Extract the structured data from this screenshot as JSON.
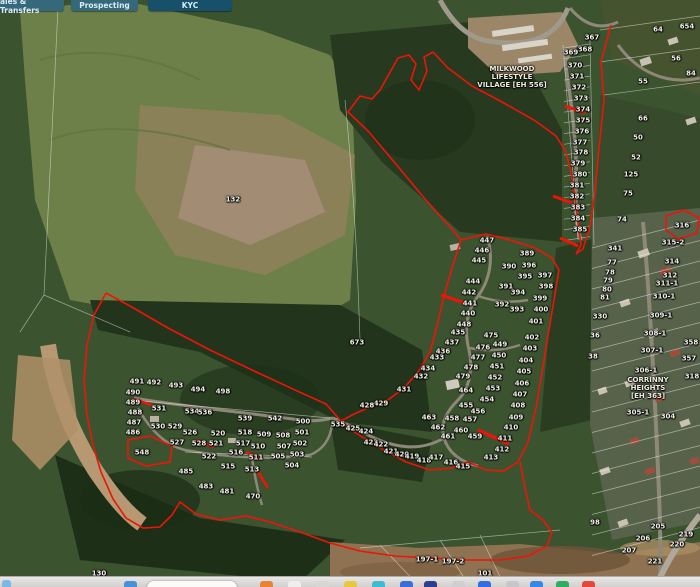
{
  "tabs": {
    "items": [
      {
        "label": "ales & Transfers",
        "x": 0,
        "w": 64,
        "color": "#36687c"
      },
      {
        "label": "Prospecting",
        "x": 71,
        "w": 67,
        "color": "#36687c"
      },
      {
        "label": "KYC",
        "x": 148,
        "w": 84,
        "color": "#17506a"
      }
    ]
  },
  "map": {
    "boundary_color": "#ee1408",
    "cadastral_line_color": "#ffffff",
    "area_labels": [
      {
        "lines": [
          "MILKWOOD",
          "LIFESTYLE",
          "VILLAGE [EH 556]"
        ],
        "x": 512,
        "y": 77
      },
      {
        "lines": [
          "CORRINNY",
          "HEIGHTS",
          "[EH 363]"
        ],
        "x": 648,
        "y": 388
      }
    ],
    "parcels": [
      [
        "367",
        592,
        38
      ],
      [
        "368",
        585,
        50
      ],
      [
        "369",
        571,
        53
      ],
      [
        "370",
        575,
        66
      ],
      [
        "371",
        577,
        77
      ],
      [
        "372",
        579,
        88
      ],
      [
        "373",
        581,
        99
      ],
      [
        "374",
        583,
        110
      ],
      [
        "375",
        583,
        121
      ],
      [
        "376",
        582,
        132
      ],
      [
        "377",
        580,
        143
      ],
      [
        "378",
        581,
        153
      ],
      [
        "379",
        578,
        164
      ],
      [
        "380",
        580,
        175
      ],
      [
        "381",
        577,
        186
      ],
      [
        "382",
        577,
        197
      ],
      [
        "383",
        578,
        208
      ],
      [
        "384",
        578,
        219
      ],
      [
        "385",
        580,
        230
      ],
      [
        "64",
        658,
        30
      ],
      [
        "654",
        687,
        27
      ],
      [
        "56",
        676,
        59
      ],
      [
        "84",
        691,
        74
      ],
      [
        "55",
        643,
        82
      ],
      [
        "66",
        643,
        119
      ],
      [
        "50",
        638,
        138
      ],
      [
        "52",
        636,
        158
      ],
      [
        "125",
        631,
        175
      ],
      [
        "75",
        628,
        194
      ],
      [
        "74",
        622,
        220
      ],
      [
        "316",
        682,
        226
      ],
      [
        "341",
        615,
        249
      ],
      [
        "315-2",
        673,
        243
      ],
      [
        "77",
        612,
        263
      ],
      [
        "78",
        610,
        273
      ],
      [
        "79",
        608,
        281
      ],
      [
        "80",
        607,
        290
      ],
      [
        "81",
        605,
        298
      ],
      [
        "314",
        672,
        262
      ],
      [
        "312",
        670,
        276
      ],
      [
        "311-1",
        667,
        284
      ],
      [
        "310-1",
        664,
        297
      ],
      [
        "330",
        600,
        317
      ],
      [
        "309-1",
        661,
        316
      ],
      [
        "36",
        595,
        336
      ],
      [
        "308-1",
        655,
        334
      ],
      [
        "38",
        593,
        357
      ],
      [
        "307-1",
        652,
        351
      ],
      [
        "306-1",
        646,
        371
      ],
      [
        "358",
        691,
        343
      ],
      [
        "357",
        689,
        359
      ],
      [
        "318",
        692,
        377
      ],
      [
        "305-1",
        638,
        413
      ],
      [
        "304",
        668,
        417
      ],
      [
        "98",
        595,
        523
      ],
      [
        "205",
        658,
        527
      ],
      [
        "219",
        686,
        535
      ],
      [
        "206",
        643,
        539
      ],
      [
        "220",
        677,
        545
      ],
      [
        "207",
        629,
        551
      ],
      [
        "221",
        655,
        562
      ],
      [
        "197-1",
        427,
        560
      ],
      [
        "197-2",
        453,
        562
      ],
      [
        "130",
        99,
        574
      ],
      [
        "101",
        485,
        574
      ],
      [
        "132",
        233,
        200
      ],
      [
        "673",
        357,
        343
      ],
      [
        "447",
        487,
        241
      ],
      [
        "446",
        482,
        251
      ],
      [
        "445",
        479,
        261
      ],
      [
        "444",
        473,
        282
      ],
      [
        "442",
        469,
        293
      ],
      [
        "441",
        470,
        304
      ],
      [
        "440",
        468,
        314
      ],
      [
        "448",
        464,
        325
      ],
      [
        "389",
        527,
        254
      ],
      [
        "390",
        509,
        267
      ],
      [
        "396",
        529,
        266
      ],
      [
        "395",
        525,
        277
      ],
      [
        "397",
        545,
        276
      ],
      [
        "391",
        506,
        287
      ],
      [
        "394",
        518,
        293
      ],
      [
        "398",
        546,
        287
      ],
      [
        "392",
        502,
        305
      ],
      [
        "393",
        517,
        310
      ],
      [
        "399",
        540,
        299
      ],
      [
        "400",
        541,
        310
      ],
      [
        "401",
        536,
        322
      ],
      [
        "402",
        532,
        338
      ],
      [
        "403",
        530,
        349
      ],
      [
        "404",
        526,
        361
      ],
      [
        "405",
        524,
        372
      ],
      [
        "406",
        522,
        384
      ],
      [
        "407",
        520,
        395
      ],
      [
        "408",
        518,
        406
      ],
      [
        "409",
        516,
        418
      ],
      [
        "410",
        511,
        428
      ],
      [
        "411",
        505,
        439
      ],
      [
        "412",
        502,
        450
      ],
      [
        "413",
        491,
        458
      ],
      [
        "435",
        458,
        333
      ],
      [
        "437",
        452,
        343
      ],
      [
        "436",
        443,
        352
      ],
      [
        "433",
        437,
        358
      ],
      [
        "434",
        428,
        369
      ],
      [
        "432",
        421,
        377
      ],
      [
        "431",
        404,
        390
      ],
      [
        "429",
        381,
        404
      ],
      [
        "428",
        367,
        406
      ],
      [
        "475",
        491,
        336
      ],
      [
        "476",
        483,
        348
      ],
      [
        "477",
        478,
        358
      ],
      [
        "478",
        471,
        368
      ],
      [
        "479",
        463,
        377
      ],
      [
        "449",
        500,
        345
      ],
      [
        "450",
        499,
        356
      ],
      [
        "451",
        497,
        367
      ],
      [
        "452",
        495,
        378
      ],
      [
        "453",
        493,
        389
      ],
      [
        "454",
        487,
        400
      ],
      [
        "464",
        466,
        391
      ],
      [
        "455",
        466,
        406
      ],
      [
        "456",
        478,
        412
      ],
      [
        "457",
        470,
        420
      ],
      [
        "458",
        452,
        419
      ],
      [
        "459",
        475,
        437
      ],
      [
        "460",
        461,
        431
      ],
      [
        "461",
        448,
        437
      ],
      [
        "462",
        438,
        428
      ],
      [
        "463",
        429,
        418
      ],
      [
        "425",
        353,
        429
      ],
      [
        "424",
        366,
        432
      ],
      [
        "423",
        371,
        443
      ],
      [
        "422",
        381,
        445
      ],
      [
        "421",
        391,
        452
      ],
      [
        "420",
        402,
        455
      ],
      [
        "419",
        412,
        457
      ],
      [
        "418",
        424,
        461
      ],
      [
        "417",
        436,
        458
      ],
      [
        "416",
        451,
        463
      ],
      [
        "415",
        463,
        467
      ],
      [
        "491",
        137,
        382
      ],
      [
        "492",
        154,
        383
      ],
      [
        "493",
        176,
        386
      ],
      [
        "494",
        198,
        390
      ],
      [
        "498",
        223,
        392
      ],
      [
        "490",
        133,
        393
      ],
      [
        "489",
        133,
        403
      ],
      [
        "488",
        135,
        413
      ],
      [
        "487",
        134,
        423
      ],
      [
        "486",
        133,
        433
      ],
      [
        "531",
        159,
        409
      ],
      [
        "534",
        192,
        412
      ],
      [
        "536",
        205,
        413
      ],
      [
        "539",
        245,
        419
      ],
      [
        "542",
        275,
        419
      ],
      [
        "500",
        303,
        422
      ],
      [
        "530",
        158,
        427
      ],
      [
        "529",
        175,
        427
      ],
      [
        "526",
        190,
        433
      ],
      [
        "520",
        218,
        434
      ],
      [
        "518",
        245,
        433
      ],
      [
        "509",
        264,
        435
      ],
      [
        "508",
        283,
        436
      ],
      [
        "501",
        302,
        433
      ],
      [
        "527",
        177,
        443
      ],
      [
        "528",
        199,
        444
      ],
      [
        "521",
        216,
        444
      ],
      [
        "517",
        243,
        444
      ],
      [
        "510",
        258,
        447
      ],
      [
        "507",
        284,
        447
      ],
      [
        "502",
        300,
        444
      ],
      [
        "548",
        142,
        453
      ],
      [
        "522",
        209,
        457
      ],
      [
        "516",
        236,
        453
      ],
      [
        "511",
        256,
        458
      ],
      [
        "505",
        278,
        457
      ],
      [
        "503",
        297,
        455
      ],
      [
        "515",
        228,
        467
      ],
      [
        "513",
        252,
        470
      ],
      [
        "504",
        292,
        466
      ],
      [
        "535",
        338,
        425
      ],
      [
        "485",
        186,
        472
      ],
      [
        "483",
        206,
        487
      ],
      [
        "481",
        227,
        492
      ],
      [
        "470",
        253,
        497
      ]
    ]
  },
  "dock": {
    "corner_icon_color": "#7ab8e8",
    "pill": {
      "x": 147,
      "w": 90
    },
    "icons": [
      {
        "x": 124,
        "c": "#4a90d9"
      },
      {
        "x": 260,
        "c": "#e8833a"
      },
      {
        "x": 288,
        "c": "#f0eeec"
      },
      {
        "x": 316,
        "c": "#d8d6d4"
      },
      {
        "x": 344,
        "c": "#e6c93c"
      },
      {
        "x": 372,
        "c": "#3fbcd4"
      },
      {
        "x": 400,
        "c": "#3a6fd8"
      },
      {
        "x": 424,
        "c": "#2a3f8f",
        "highlight": true
      },
      {
        "x": 452,
        "c": "#d0ced0"
      },
      {
        "x": 478,
        "c": "#2f6fe0"
      },
      {
        "x": 506,
        "c": "#c8c6c8"
      },
      {
        "x": 530,
        "c": "#3a86e8"
      },
      {
        "x": 556,
        "c": "#2fae62"
      },
      {
        "x": 582,
        "c": "#e04a3a"
      }
    ]
  }
}
